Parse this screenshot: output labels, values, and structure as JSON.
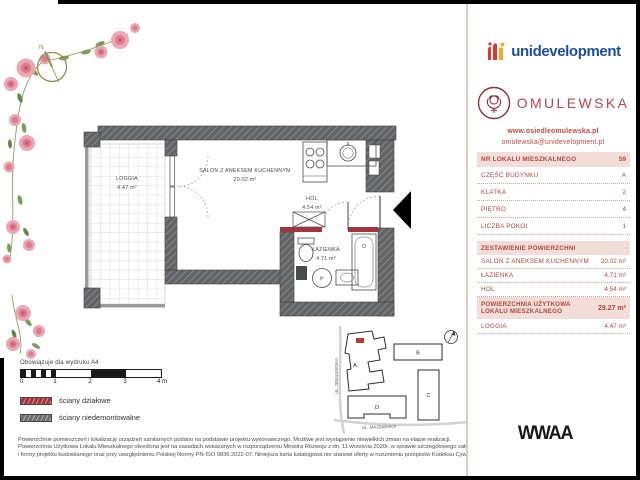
{
  "colors": {
    "accent_red": "#a6343c",
    "table_text": "#b2463e",
    "table_header_bg": "#f3ddd8",
    "brand_blue": "#1b4f9e",
    "project_red": "#b5464a",
    "wall_gray": "#636466",
    "divider_pink": "#e7c6c0"
  },
  "sidebar": {
    "developer_logo": "unidevelopment",
    "project_logo": "OMULEWSKA",
    "website": "www.osiedleomulewska.pl",
    "email": "omulewska@unidevelopment.pl",
    "unit_table": {
      "header_label": "NR LOKALU MIESZKALNEGO",
      "header_value": "59",
      "rows": [
        {
          "label": "CZĘŚĆ BUDYNKU",
          "value": "A"
        },
        {
          "label": "KLATKA",
          "value": "2"
        },
        {
          "label": "PIĘTRO",
          "value": "4"
        },
        {
          "label": "LICZBA POKOI",
          "value": "1"
        }
      ]
    },
    "area_table": {
      "header": "ZESTAWIENIE POWIERZCHNI",
      "rows": [
        {
          "label": "SALON Z ANEKSEM KUCHENNYM",
          "value": "20.02 m²"
        },
        {
          "label": "ŁAZIENKA",
          "value": "4.71 m²"
        },
        {
          "label": "HOL",
          "value": "4.54 m²"
        }
      ],
      "total_label": "POWIERZCHNIA UŻYTKOWA LOKALU MIESZKALNEGO",
      "total_value": "29.27 m²",
      "loggia_label": "LOGGIA",
      "loggia_value": "4.47 m²"
    },
    "architect_logo": "WWAA"
  },
  "plan": {
    "compass_label": "N",
    "washer_label": "P",
    "rooms": {
      "loggia": {
        "name": "LOGGIA",
        "area": "4.47 m²"
      },
      "salon": {
        "name": "SALON Z ANEKSEM KUCHENNYM",
        "area": "20.02 m²"
      },
      "hol": {
        "name": "HOL",
        "area": "4.54 m²"
      },
      "lazienka": {
        "name": "ŁAZIENKA",
        "area": "4.71 m²"
      }
    }
  },
  "legend": {
    "print_note": "Obowiązuje dla wydruku A4",
    "scale_ticks": [
      "0",
      "1",
      "2",
      "3",
      "4 m"
    ],
    "partition_walls": "ściany działowe",
    "structural_walls": "ściany niedemontowalne"
  },
  "sitemap": {
    "street_left": "UL. OMULEWSKA",
    "street_bottom": "UL. MAJDAŃSKA",
    "buildings": {
      "a": "A",
      "b": "B",
      "c": "C",
      "d": "D"
    }
  },
  "disclaimer": {
    "line1": "Powierzchnie pomieszczeń i lokalizację urządzeń sanitarnych podano na podstawie projektu wykonawczego. Możliwe jest wystąpienie niewielkich zmian na etapie realizacji.",
    "line2": "Powierzchnia Użytkowa Lokalu Mieszkalnego określona jest na zasadach wskazanych w rozporządzeniu Ministra Rozwoju z dn. 11 września 2020r. w sprawie szczegółowego zakresu",
    "line3": "i formy projektu budowlanego oraz przy uwzględnieniu Polskiej Normy PN-ISO 9836:2022-07. Niniejsza karta katalogowa nie stanowi oferty w rozumieniu przepisów Kodeksu Cywilnego."
  }
}
